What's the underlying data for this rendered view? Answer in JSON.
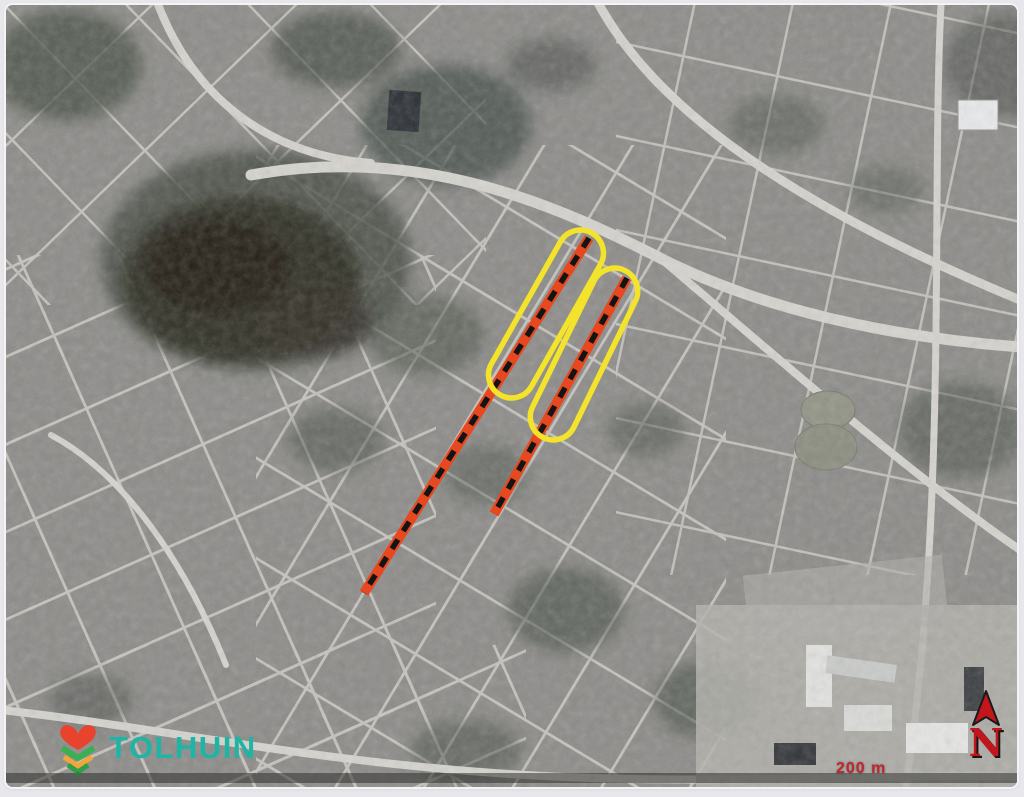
{
  "logo": {
    "text": "TOLHUIN",
    "color": "#1db5a5",
    "icon": "heart-leaves"
  },
  "north": {
    "label": "N",
    "color": "#c3161c"
  },
  "scale": {
    "text": "200 m",
    "color": "#c0262c"
  },
  "annotations": {
    "route_color": "#e8481f",
    "route_dash_color": "#141414",
    "highlight_color": "#f3e32b",
    "routes": [
      {
        "name": "route-segment-long",
        "x1": 583,
        "y1": 233,
        "x2": 358,
        "y2": 588
      },
      {
        "name": "route-segment-short",
        "x1": 621,
        "y1": 273,
        "x2": 488,
        "y2": 509
      }
    ],
    "highlights": [
      {
        "name": "highlight-capsule-1",
        "cx": 540,
        "cy": 309,
        "angle": 29.5
      },
      {
        "name": "highlight-capsule-2",
        "cx": 578,
        "cy": 349,
        "angle": 26
      }
    ]
  }
}
